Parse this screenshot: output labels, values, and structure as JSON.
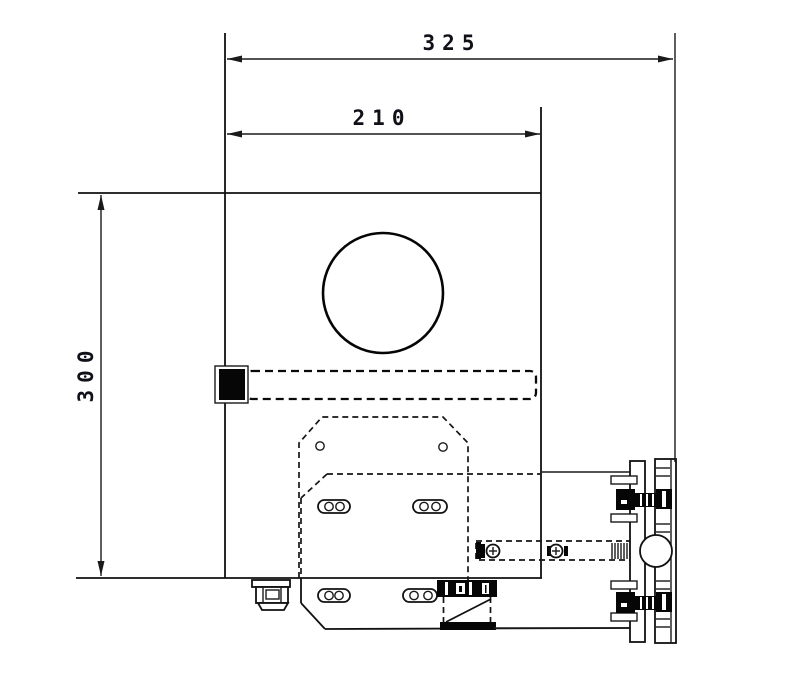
{
  "drawing": {
    "dimensions": {
      "overall_width": "325",
      "body_width": "210",
      "height": "300"
    }
  }
}
